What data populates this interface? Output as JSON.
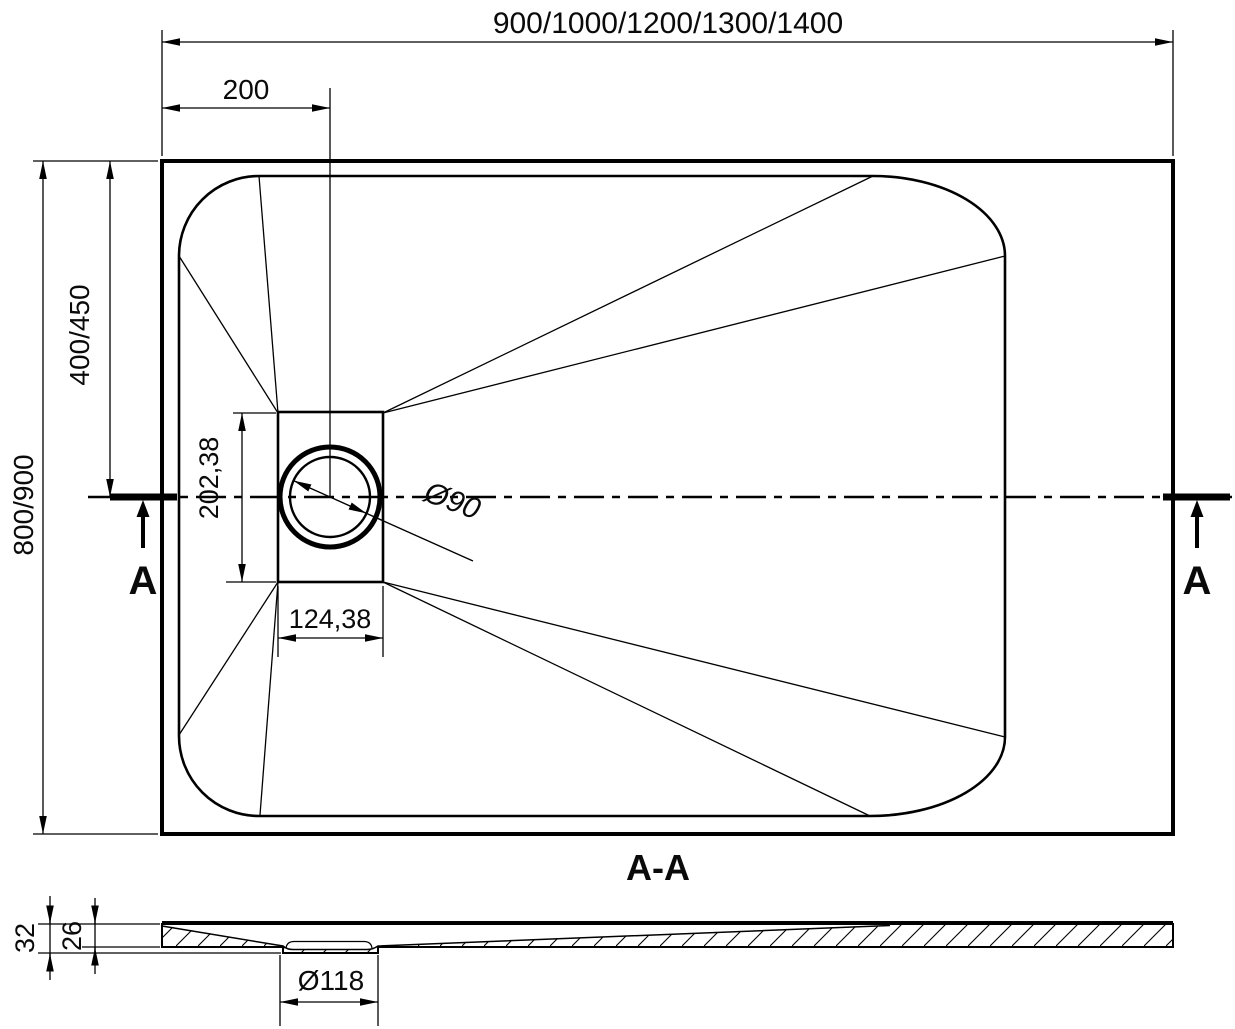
{
  "drawing": {
    "colors": {
      "line": "#000000",
      "background": "#ffffff",
      "text": "#0a0a0a"
    },
    "top_view": {
      "width_options_label": "900/1000/1200/1300/1400",
      "drain_offset_x_label": "200",
      "depth_options_label": "800/900",
      "drain_offset_y_label": "400/450",
      "drain_plate_height_label": "202,38",
      "drain_plate_width_label": "124,38",
      "drain_diameter_label": "Ø90",
      "section_marker_left": "A",
      "section_marker_right": "A"
    },
    "section_view": {
      "title": "A-A",
      "total_height_label": "32",
      "base_thickness_label": "26",
      "drain_hole_diameter_label": "Ø118"
    }
  }
}
